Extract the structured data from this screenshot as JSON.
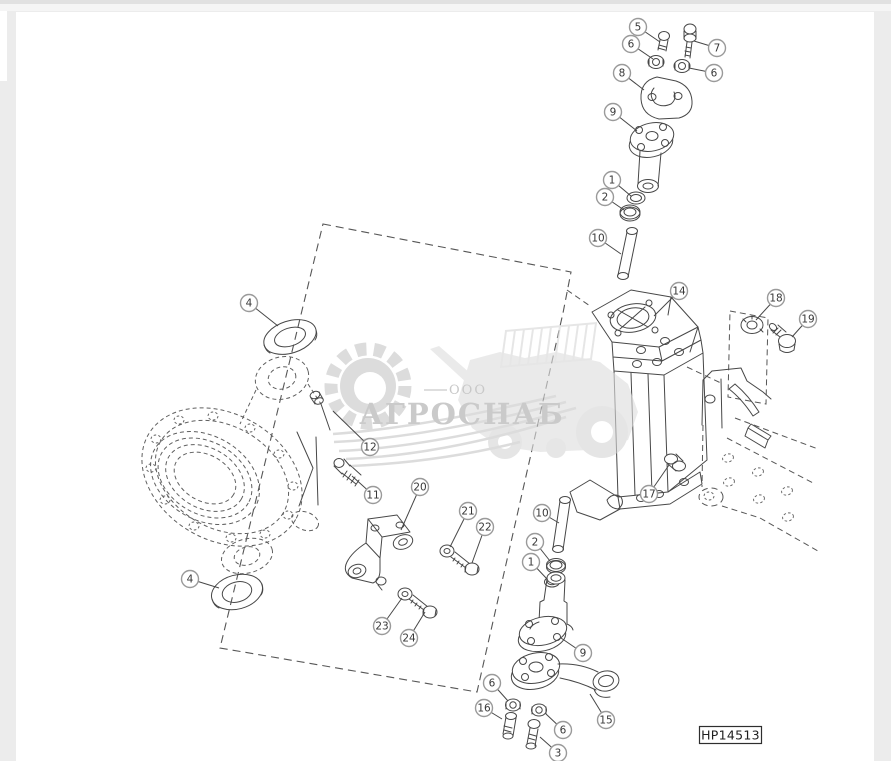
{
  "theme": {
    "page_background": "#ececec",
    "canvas_background": "#ffffff",
    "top_bar_color": "#e1e1e1",
    "top_bar_color2": "#f5f5f5",
    "line_color": "#474747",
    "hidden_line_color": "#5f5f5f",
    "watermark_gray": "#c7c7c7",
    "watermark_text_gray": "#ababab",
    "callout_ring_color": "#9a9a9a",
    "callout_number_color": "#383838"
  },
  "watermark": {
    "company_prefix": "ООО",
    "company_name": "АГРОСНАБ"
  },
  "diagram": {
    "plate_label": "HP14513",
    "callouts": [
      {
        "label": "5",
        "x": 638,
        "y": 27,
        "tx": 660,
        "ty": 42
      },
      {
        "label": "6",
        "x": 631,
        "y": 44,
        "tx": 653,
        "ty": 59
      },
      {
        "label": "7",
        "x": 717,
        "y": 48,
        "tx": 694,
        "ty": 41
      },
      {
        "label": "6",
        "x": 714,
        "y": 73,
        "tx": 689,
        "ty": 68
      },
      {
        "label": "8",
        "x": 622,
        "y": 73,
        "tx": 644,
        "ty": 90
      },
      {
        "label": "9",
        "x": 613,
        "y": 112,
        "tx": 637,
        "ty": 131
      },
      {
        "label": "1",
        "x": 612,
        "y": 180,
        "tx": 631,
        "ty": 196
      },
      {
        "label": "2",
        "x": 605,
        "y": 197,
        "tx": 624,
        "ty": 210
      },
      {
        "label": "10",
        "x": 598,
        "y": 238,
        "tx": 621,
        "ty": 254
      },
      {
        "label": "14",
        "x": 679,
        "y": 291,
        "tx": 654,
        "ty": 316
      },
      {
        "label": "18",
        "x": 776,
        "y": 298,
        "tx": 756,
        "ty": 320
      },
      {
        "label": "19",
        "x": 808,
        "y": 319,
        "tx": 792,
        "ty": 337
      },
      {
        "label": "4",
        "x": 249,
        "y": 303,
        "tx": 278,
        "ty": 326
      },
      {
        "label": "12",
        "x": 370,
        "y": 447,
        "tx": 333,
        "ty": 411
      },
      {
        "label": "11",
        "x": 373,
        "y": 495,
        "tx": 352,
        "ty": 476
      },
      {
        "label": "20",
        "x": 420,
        "y": 487,
        "tx": 401,
        "ty": 530
      },
      {
        "label": "21",
        "x": 468,
        "y": 511,
        "tx": 450,
        "ty": 547
      },
      {
        "label": "22",
        "x": 485,
        "y": 527,
        "tx": 472,
        "ty": 563
      },
      {
        "label": "23",
        "x": 382,
        "y": 626,
        "tx": 402,
        "ty": 598
      },
      {
        "label": "24",
        "x": 409,
        "y": 638,
        "tx": 425,
        "ty": 612
      },
      {
        "label": "4",
        "x": 190,
        "y": 579,
        "tx": 219,
        "ty": 588
      },
      {
        "label": "17",
        "x": 649,
        "y": 494,
        "tx": 669,
        "ty": 465
      },
      {
        "label": "10",
        "x": 542,
        "y": 513,
        "tx": 559,
        "ty": 523
      },
      {
        "label": "2",
        "x": 535,
        "y": 542,
        "tx": 550,
        "ty": 561
      },
      {
        "label": "1",
        "x": 531,
        "y": 562,
        "tx": 547,
        "ty": 579
      },
      {
        "label": "9",
        "x": 583,
        "y": 653,
        "tx": 561,
        "ty": 638
      },
      {
        "label": "15",
        "x": 606,
        "y": 720,
        "tx": 590,
        "ty": 694
      },
      {
        "label": "6",
        "x": 492,
        "y": 683,
        "tx": 508,
        "ty": 701
      },
      {
        "label": "16",
        "x": 484,
        "y": 708,
        "tx": 502,
        "ty": 719
      },
      {
        "label": "6",
        "x": 563,
        "y": 730,
        "tx": 546,
        "ty": 714
      },
      {
        "label": "3",
        "x": 558,
        "y": 753,
        "tx": 540,
        "ty": 737
      }
    ]
  }
}
